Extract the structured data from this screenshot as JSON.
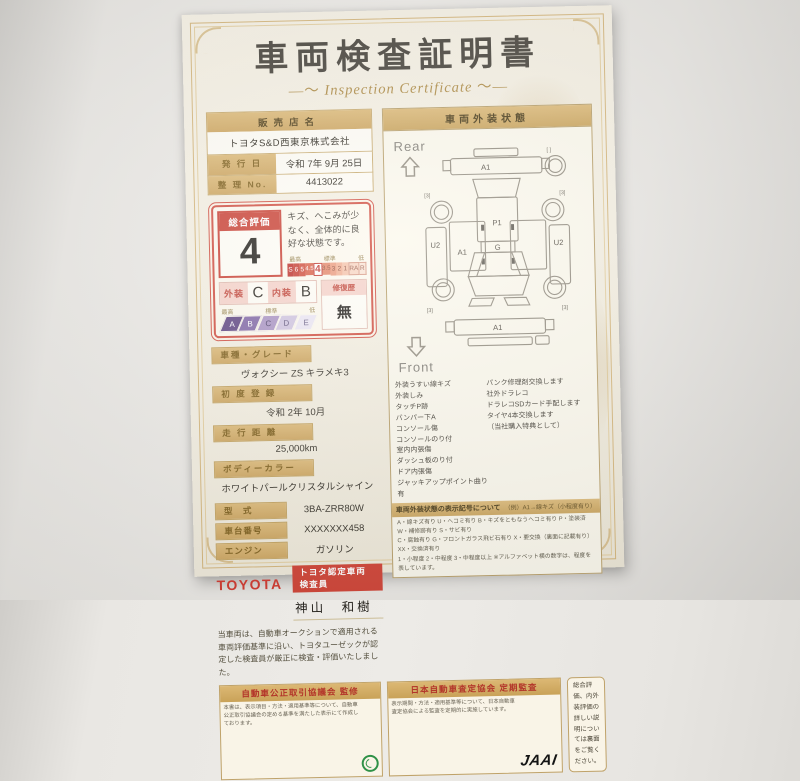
{
  "certificate": {
    "title": "車両検査証明書",
    "subtitle": "Inspection Certificate",
    "dealer": {
      "label": "販売店名",
      "value": "トヨタS&D西東京株式会社"
    },
    "issue": {
      "label": "発 行 日",
      "value": "令和 7年 9月 25日"
    },
    "ref": {
      "label": "整 理 No.",
      "value": "4413022"
    },
    "rating": {
      "overall_label": "総合評価",
      "overall_value": "4",
      "comment": "キズ、へこみが少なく、全体的に良好な状態です。",
      "scale_top_labels": [
        "最高",
        "標準",
        "低"
      ],
      "scale": [
        "S",
        "6",
        "5",
        "4.5",
        "4",
        "3.5",
        "3",
        "2",
        "1",
        "RA",
        "R"
      ],
      "exterior_label": "外装",
      "exterior_value": "C",
      "interior_label": "内装",
      "interior_value": "B",
      "repair_label": "修復歴",
      "repair_value": "無",
      "grade_scale": [
        "A",
        "B",
        "C",
        "D",
        "E"
      ]
    },
    "specs": [
      {
        "label": "車種・グレード",
        "value": "ヴォクシー ZS キラメキ3"
      },
      {
        "label": "初 度 登 録",
        "value": "令和 2年 10月"
      },
      {
        "label": "走 行 距 離",
        "value": "25,000km"
      },
      {
        "label": "ボディーカラー",
        "value": "ホワイトパールクリスタルシャイン"
      },
      {
        "label": "型　式",
        "value": "3BA-ZRR80W"
      },
      {
        "label": "車台番号",
        "value": "XXXXXXX458"
      },
      {
        "label": "エンジン",
        "value": "ガソリン"
      }
    ],
    "inspector": {
      "brand": "TOYOTA",
      "badge": "トヨタ認定車両検査員",
      "name": "神山　和樹"
    },
    "disclaimer": "当車両は、自動車オークションで適用される車両評価基準に沿い、トヨタユーゼックが認定した検査員が厳正に検査・評価いたしました。",
    "exterior_panel": {
      "header": "車両外装状態",
      "rear_label": "Rear",
      "front_label": "Front",
      "diagram": {
        "rear_bumper": "A1",
        "left_quarter": "U2",
        "right_quarter": "U2",
        "left_door": "A1",
        "roof": "P1",
        "hood": "G",
        "front_bumper": "A1",
        "wheel_mark": "[3]",
        "spare_mark": "[  ]"
      },
      "notes_left": [
        "外装うすい線キズ",
        "外装しみ",
        "タッチP跡",
        "バンパー下A",
        "コンソール傷",
        "コンソールのり付",
        "室内内張傷",
        "ダッシュ板のり付",
        "ドア内張傷",
        "ジャッキアップポイント曲り有"
      ],
      "notes_right": [
        "パンク修理剤交換します",
        "社外ドラレコ",
        "ドラレコSDカード手配します",
        "タイヤ4本交換します",
        "（当社購入特典として）"
      ],
      "legend_header": "車両外装状態の表示記号について",
      "legend_example": "（例）A1→線キズ（小程度有り）",
      "legend_lines": [
        "A・線キズ有り U・ヘコミ有り B・キズをともなうヘコミ有り P・塗装済 W・補修跡有り S・サビ有り",
        "C・腐蝕有り G・フロントガラス飛ビ石有り X・要交換（裏面に記載有り） XX・交換済有り",
        "1・小程度 2・中程度 3・中程度以上 ※アルファベット横の数字は、程度を表しています。"
      ]
    },
    "footer": {
      "box1_title": "自動車公正取引協議会 監修",
      "box1_text": "本書は、表示項目・方法・適用基準等について、自動車公正取引協議会の定める基準を満たした表示にて作成しております。",
      "box2_title": "日本自動車査定協会 定期監査",
      "box2_text": "表示期間・方法・適用基準等について、日本自動車査定協会による監査を定期的に実施しています。",
      "box2_logo": "JAAI",
      "box3_text": "総合評価、内外装評価の詳しい説明については裏面をご覧ください。"
    },
    "colors": {
      "accent_red": "#c93d30",
      "tan": "#d0ab62",
      "purple": "#5c4280"
    }
  }
}
